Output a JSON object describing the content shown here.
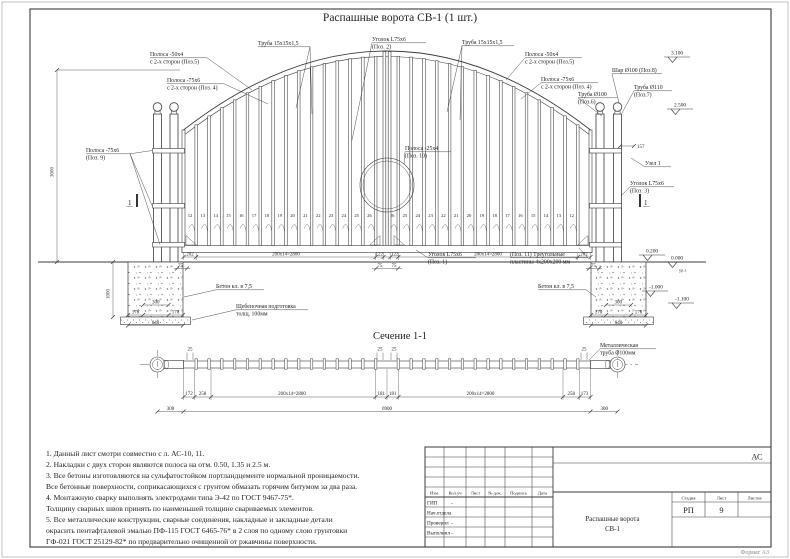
{
  "title": "Распашные ворота СВ-1 (1 шт.)",
  "section_title": "Сечение 1-1",
  "ann": {
    "polosa50_l1": "Полоса -50х4",
    "polosa50_l2": "с 2-х сторон (Поз.5)",
    "polosa75_l1": "Полоса -75х6",
    "polosa75_l2": "с 2-х сторон (Поз. 4)",
    "truba15": "Труба 15х15х1,5",
    "ugolok2_1": "Уголок L75х6",
    "ugolok2_2": "(Поз. 2)",
    "polosa50_r1": "Полоса -50х4",
    "polosa50_r2": "с 2-х сторон (Поз.5)",
    "polosa75_r1": "Полоса -75х6",
    "polosa75_r2": "с 2-х сторон (Поз. 4)",
    "truba100_1": "Труба Ø100",
    "truba100_2": "(Поз.6)",
    "shar": "Шар Ø100 (Поз.8)",
    "truba110_1": "Труба Ø110",
    "truba110_2": "(Поз.7)",
    "polosa9_1": "Полоса -75х6",
    "polosa9_2": "(Поз. 9)",
    "polosa10_1": "Полоса -25х4",
    "polosa10_2": "(Поз. 10)",
    "ugolok1_1": "Уголок L75х6",
    "ugolok1_2": "(Поз. 1)",
    "plastiny_1": "(Поз. 11) Треугольные",
    "plastiny_2": "пластины 4х200х200 мм",
    "ugolok3_1": "Уголок L75х6",
    "ugolok3_2": "(Поз. 3)",
    "beton": "Бетон кл. в 7,5",
    "scheben_1": "Щебеночная подготовка",
    "scheben_2": "толщ. 100мм",
    "uzel": "Узел 1",
    "metal_1": "Металлическая",
    "metal_2": "труба Ø100мм",
    "sec_mark": "1"
  },
  "marks": {
    "m3100": "3.100",
    "m2500": "2.500",
    "m0200": "0.200",
    "m0000": "0.000",
    "urz": "ур.з.",
    "m1000": "-1.000",
    "m1100": "-1.100"
  },
  "dims": {
    "d157": "157",
    "v3000": "3000",
    "v1000": "1000",
    "b202": "202",
    "b2800": "200х14=2800",
    "b122": "122",
    "b75": "75",
    "f300": "300",
    "f170": "170",
    "f640": "640",
    "s172": "172",
    "s258": "258",
    "s2800": "200х14=2800",
    "s181": "181",
    "s173": "173",
    "s25": "25",
    "s300": "300",
    "s6900": "6900"
  },
  "picket_numbers_left": [
    12,
    13,
    14,
    15,
    16,
    17,
    18,
    19,
    20,
    21,
    22,
    23,
    24,
    25,
    26
  ],
  "picket_numbers_right": [
    26,
    25,
    24,
    23,
    22,
    21,
    20,
    19,
    18,
    17,
    16,
    15,
    14,
    13,
    12
  ],
  "notes": [
    "1. Данный лист смотри совместно с л. АС-10, 11.",
    "2. Накладки с двух сторон являются полоса на отм. 0.50, 1.35 и 2.5 м.",
    "3. Все бетоны изготовляются на сульфатостойком портландцементе нормальной проницаемости.",
    "Все бетонные поверхности, соприкасающихся с грунтом обмазать горячим битумом за два раза.",
    "4. Монтажную сварку выполнять электродами типа Э-42 по ГОСТ 9467-75*.",
    "Толщину сварных швов принять по наименьшей толщине свариваемых элементов.",
    "5. Все металлические конструкции, сварные соединения, накладные и закладные детали",
    "окрасить пентафталевой эмалью ПФ-115 ГОСТ 6465-76* в 2 слоя по одному слою грунтовки",
    "ГФ-021 ГОСТ 25129-82* по предварительно очищенной от ржавчины поверхности."
  ],
  "title_block": {
    "code": "АС",
    "header": [
      "Изм.",
      "Кол.уч",
      "Лист",
      "№ док.",
      "Подпись",
      "Дата"
    ],
    "roles": [
      "ГИП",
      "Нач.отдела",
      "Проверил",
      "Выполнил"
    ],
    "dash": "-",
    "stage_label": "Стадия",
    "sheet_label": "Лист",
    "sheets_label": "Листов",
    "stage": "РП",
    "sheet": "9",
    "doc_1": "Распашные ворота",
    "doc_2": "СВ-1",
    "format": "Формат А3"
  }
}
